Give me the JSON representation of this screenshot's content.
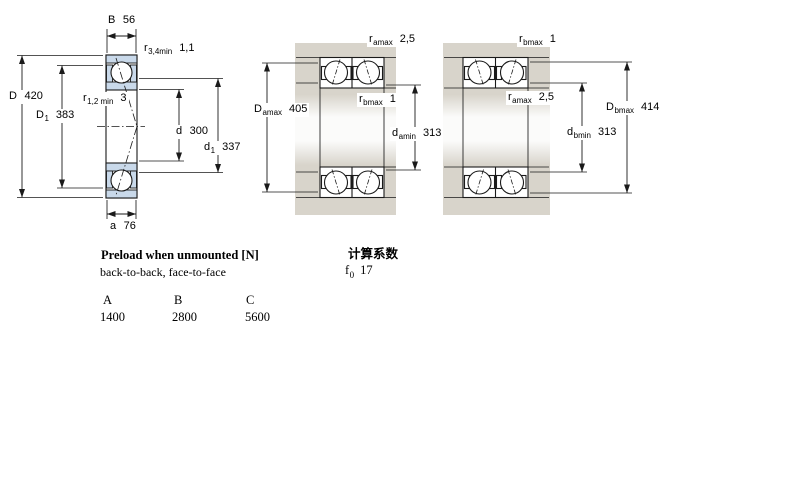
{
  "colors": {
    "bearing_ring_fill": "#c9d9ea",
    "housing_fill": "#d8d4cb",
    "line": "#1a1a1a"
  },
  "figures": {
    "single_bearing": {
      "dims": {
        "B": {
          "base": "B",
          "value": "56"
        },
        "r34": {
          "base": "r",
          "sub": "3,4min",
          "value": "1,1"
        },
        "D": {
          "base": "D",
          "value": "420"
        },
        "D1": {
          "base": "D",
          "sub": "1",
          "value": "383"
        },
        "r12": {
          "base": "r",
          "sub": "1,2 min",
          "value": "3"
        },
        "d": {
          "base": "d",
          "value": "300"
        },
        "d1": {
          "base": "d",
          "sub": "1",
          "value": "337"
        },
        "a": {
          "base": "a",
          "value": "76"
        }
      }
    },
    "mount_a": {
      "dims": {
        "ramax": {
          "base": "r",
          "sub": "amax",
          "value": "2,5"
        },
        "rbmax": {
          "base": "r",
          "sub": "bmax",
          "value": "1"
        },
        "Damax": {
          "base": "D",
          "sub": "amax",
          "value": "405"
        },
        "damin": {
          "base": "d",
          "sub": "amin",
          "value": "313"
        }
      }
    },
    "mount_b": {
      "dims": {
        "rbmax": {
          "base": "r",
          "sub": "bmax",
          "value": "1"
        },
        "ramax": {
          "base": "r",
          "sub": "amax",
          "value": "2,5"
        },
        "Dbmax": {
          "base": "D",
          "sub": "bmax",
          "value": "414"
        },
        "dbmin": {
          "base": "d",
          "sub": "bmin",
          "value": "313"
        }
      }
    }
  },
  "preload_section": {
    "title": "Preload when unmounted [N]",
    "subtitle": "back-to-back, face-to-face",
    "columns": [
      "A",
      "B",
      "C"
    ],
    "values": [
      "1400",
      "2800",
      "5600"
    ]
  },
  "calc_section": {
    "title": "计算系数",
    "factor": {
      "base": "f",
      "sub": "0",
      "value": "17"
    }
  }
}
